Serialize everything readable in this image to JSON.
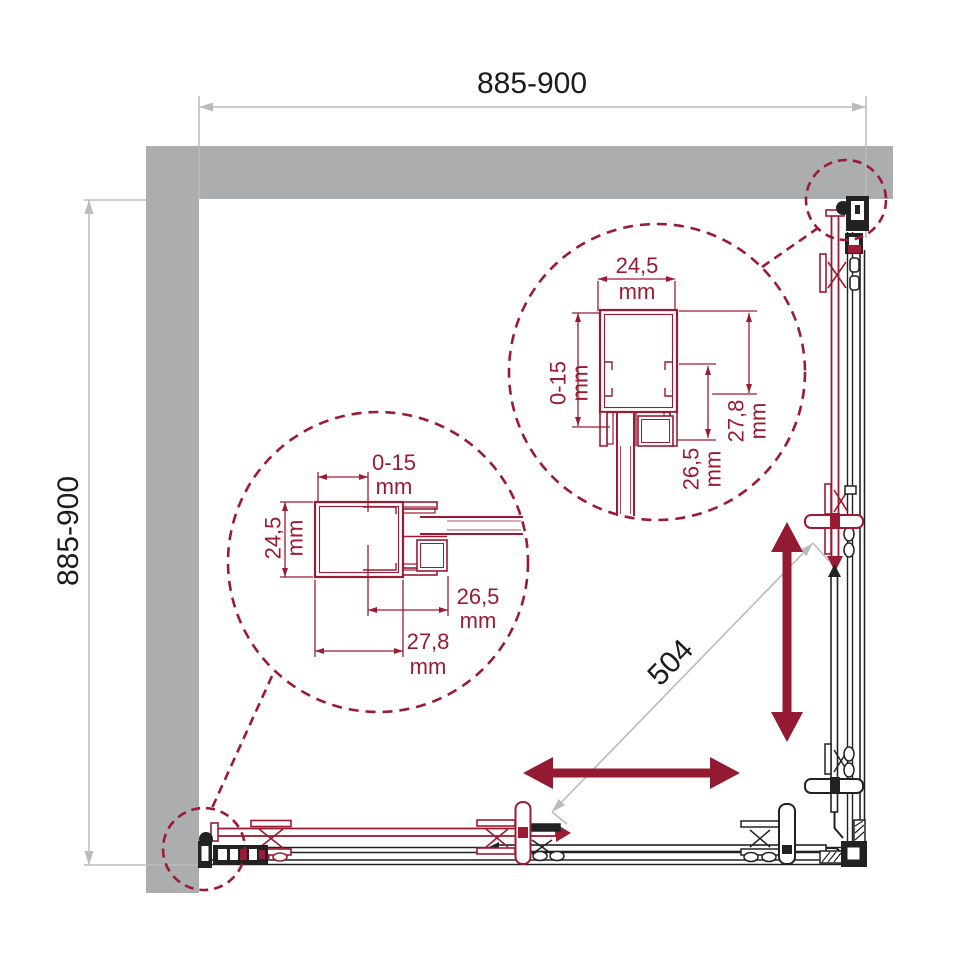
{
  "drawing": {
    "overall_width": {
      "value": "885-900"
    },
    "overall_depth": {
      "value": "885-900"
    },
    "door_opening": {
      "value": "504"
    }
  },
  "detail_top_right": {
    "profile_width": {
      "value": "24,5",
      "unit": "mm"
    },
    "adjustment_range": {
      "value": "0-15",
      "unit": "mm"
    },
    "inner_depth": {
      "value": "26,5",
      "unit": "mm"
    },
    "total_depth": {
      "value": "27,8",
      "unit": "mm"
    }
  },
  "detail_bottom_left": {
    "adjustment_range": {
      "value": "0-15",
      "unit": "mm"
    },
    "profile_width": {
      "value": "24,5",
      "unit": "mm"
    },
    "inner_depth": {
      "value": "26,5",
      "unit": "mm"
    },
    "total_depth": {
      "value": "27,8",
      "unit": "mm"
    }
  },
  "colors": {
    "accent_red": "#9A1B33",
    "arrow_red": "#931A31",
    "wall_gray": "#ABADAF",
    "dim_gray": "#B9BBBD",
    "line_black": "#222222"
  }
}
